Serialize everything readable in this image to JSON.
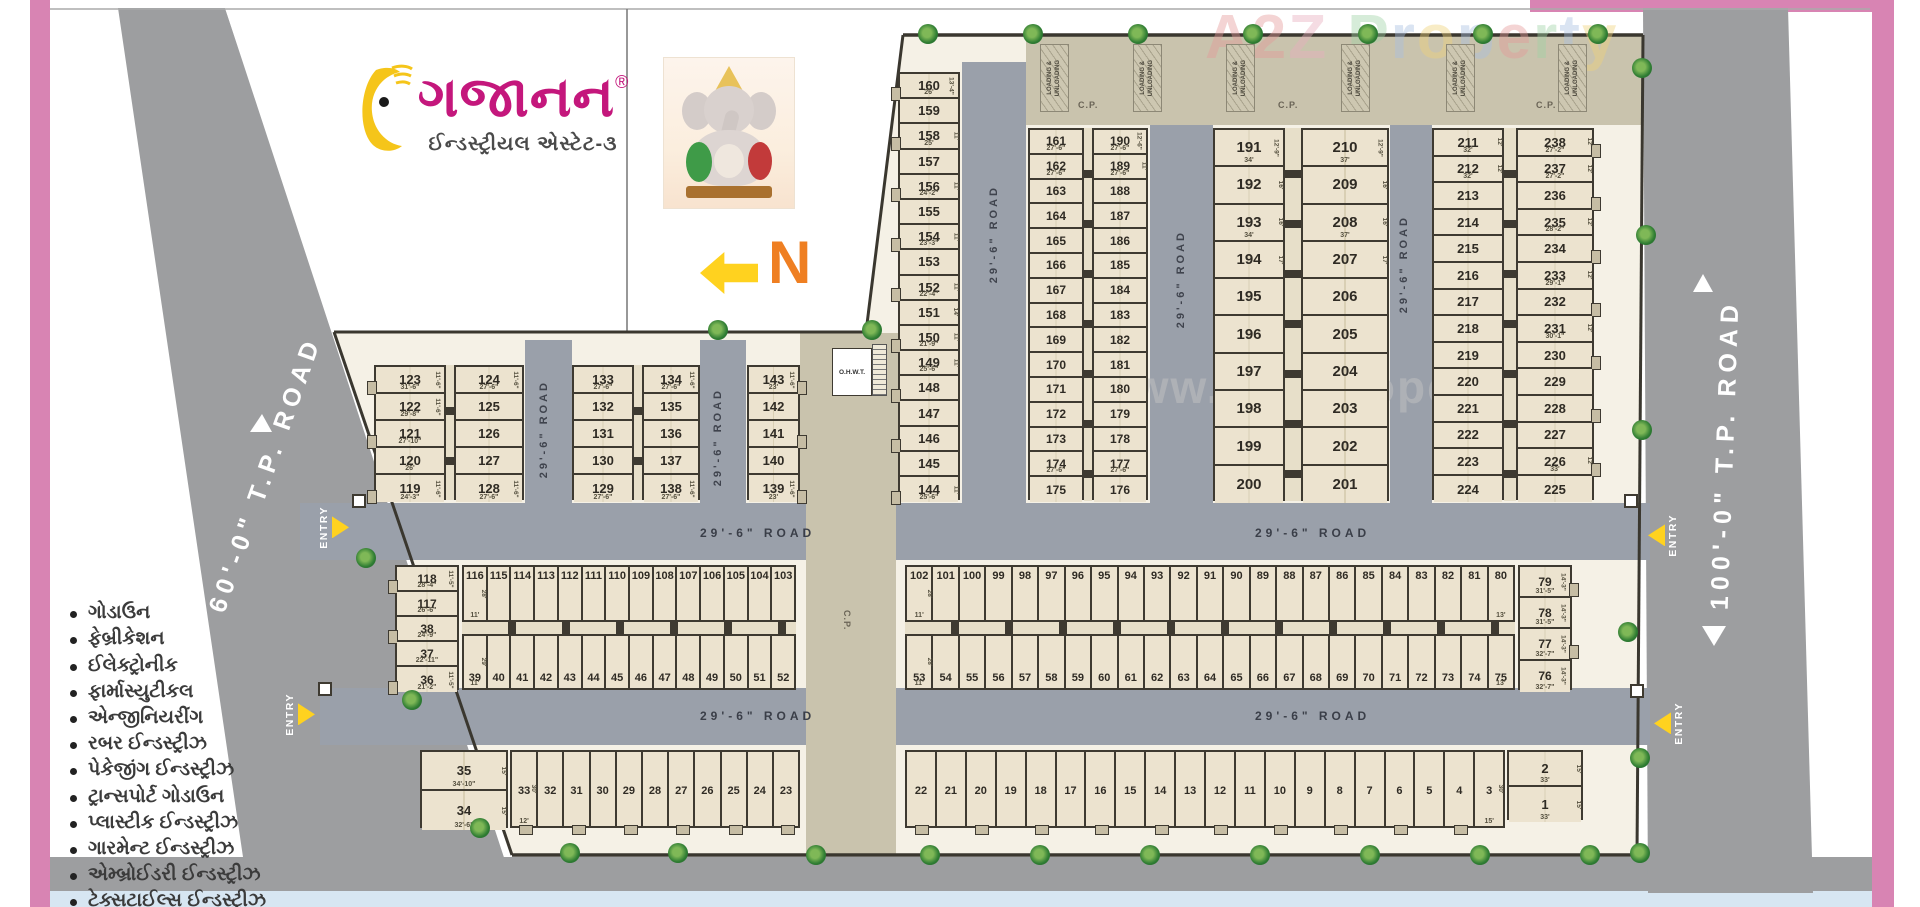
{
  "branding": {
    "name": "ગજાનન",
    "reg": "®",
    "subtitle": "ઈન્ડસ્ટ્રીયલ એસ્ટેટ-૩"
  },
  "watermarks": {
    "corner": "A2Z Property",
    "center": "www.A2ZProperty.in"
  },
  "labels": {
    "north": "N",
    "entry": "ENTRY",
    "cp": "C.P.",
    "ohwt": "O.H.W.T.",
    "loading_lines": [
      "LOADING &",
      "UNLOADING"
    ]
  },
  "roads": {
    "internal": "29'-6\" ROAD",
    "left_tp": "60'-0\" T.P. ROAD",
    "right_tp": "100'-0\" T.P. ROAD"
  },
  "industries": [
    "ગોડાઉન",
    "ફેબ્રીકેશન",
    "ઈલેક્ટ્રોનીક",
    "ફાર્માસ્યુટીકલ",
    "એન્જીનિયરીંગ",
    "રબર ઈન્ડસ્ટ્રીઝ",
    "પેકેજીંગ ઈન્ડસ્ટ્રીઝ",
    "ટ્રાન્સપોર્ટ ગોડાઉન",
    "પ્લાસ્ટીક ઈન્ડસ્ટ્રીઝ",
    "ગારમેન્ટ ઈન્ડસ્ટ્રીઝ",
    "એમ્બ્રોઈડરી ઈન્ડસ્ટ્રીઝ",
    "ટેક્સટાઈલ્સ ઈન્ડસ્ટ્રીઝ"
  ],
  "plot_blocks": {
    "colA": {
      "plots": [
        160,
        159,
        158,
        157,
        156,
        155,
        154,
        153,
        152,
        151,
        150,
        149,
        148,
        147,
        146,
        145,
        144
      ],
      "dims": {
        "160": [
          "26'",
          "13'-4\""
        ],
        "158": [
          "25'",
          "11'"
        ],
        "156": [
          "24'-2\"",
          "11'"
        ],
        "154": [
          "23'-3\"",
          "11'"
        ],
        "152": [
          "22'-4\"",
          "11'"
        ],
        "151": [
          "",
          "14'"
        ],
        "150": [
          "21'-9\"",
          "11'"
        ],
        "149": [
          "25'-6\"",
          "11'"
        ],
        "144": [
          "25'-6\"",
          "11'"
        ]
      }
    },
    "bB_L": {
      "plots": [
        161,
        162,
        163,
        164,
        165,
        166,
        167,
        168,
        169,
        170,
        171,
        172,
        173,
        174,
        175
      ],
      "dims": {
        "161": [
          "27'-6\"",
          ""
        ],
        "162": [
          "27'-6\"",
          ""
        ],
        "174": [
          "27'-6\"",
          ""
        ],
        "175": [
          "",
          ""
        ]
      }
    },
    "bB_R": {
      "plots": [
        190,
        189,
        188,
        187,
        186,
        185,
        184,
        183,
        182,
        181,
        180,
        179,
        178,
        177,
        176
      ],
      "dims": {
        "190": [
          "27'-6\"",
          "12'-6\""
        ],
        "189": [
          "27'-6\"",
          "11'"
        ],
        "177": [
          "27'-6\"",
          ""
        ]
      }
    },
    "bC_L": {
      "plots": [
        191,
        192,
        193,
        194,
        195,
        196,
        197,
        198,
        199,
        200
      ],
      "dims": {
        "191": [
          "34'",
          "12'-9\""
        ],
        "192": [
          "",
          "16'"
        ],
        "193": [
          "34'",
          "16'"
        ],
        "194": [
          "",
          "17'"
        ]
      }
    },
    "bC_R": {
      "plots": [
        210,
        209,
        208,
        207,
        206,
        205,
        204,
        203,
        202,
        201
      ],
      "dims": {
        "210": [
          "37'",
          "12'-9\""
        ],
        "209": [
          "",
          "16'"
        ],
        "208": [
          "37'",
          "16'"
        ],
        "207": [
          "",
          "17'"
        ]
      }
    },
    "bD_L": {
      "plots": [
        211,
        212,
        213,
        214,
        215,
        216,
        217,
        218,
        219,
        220,
        221,
        222,
        223,
        224
      ],
      "dims": {
        "211": [
          "32'",
          "12'"
        ],
        "212": [
          "32'",
          "12'"
        ]
      }
    },
    "bD_R": {
      "plots": [
        238,
        237,
        236,
        235,
        234,
        233,
        232,
        231,
        230,
        229,
        228,
        227,
        226,
        225
      ],
      "dims": {
        "238": [
          "27'-2\"",
          "12'"
        ],
        "237": [
          "27'-2\"",
          "12'"
        ],
        "235": [
          "28'-2\"",
          "12'"
        ],
        "233": [
          "29'-1\"",
          "12'"
        ],
        "231": [
          "30'-1\"",
          "12'"
        ],
        "226": [
          "33'",
          "12'"
        ]
      }
    },
    "b119_L": {
      "plots": [
        123,
        122,
        121,
        120,
        119
      ],
      "dims": {
        "123": [
          "31'-6\"",
          "11'-6\""
        ],
        "122": [
          "29'-8\"",
          "11'-6\""
        ],
        "121": [
          "27'-10\"",
          ""
        ],
        "120": [
          "26'",
          ""
        ],
        "119": [
          "24'-3\"",
          "11'-6\""
        ]
      }
    },
    "b119_R": {
      "plots": [
        124,
        125,
        126,
        127,
        128
      ],
      "dims": {
        "124": [
          "27'-6\"",
          "11'-6\""
        ],
        "128": [
          "27'-6\"",
          "11'-6\""
        ]
      }
    },
    "b129_L": {
      "plots": [
        133,
        132,
        131,
        130,
        129
      ],
      "dims": {
        "133": [
          "27'-6\"",
          ""
        ],
        "129": [
          "27'-6\"",
          ""
        ]
      }
    },
    "b129_R": {
      "plots": [
        134,
        135,
        136,
        137,
        138
      ],
      "dims": {
        "134": [
          "27'-6\"",
          "11'-6\""
        ],
        "138": [
          "27'-6\"",
          "11'-6\""
        ]
      }
    },
    "col139": {
      "plots": [
        143,
        142,
        141,
        140,
        139
      ],
      "dims": {
        "143": [
          "23'",
          "11'-6\""
        ],
        "139": [
          "23'",
          "11'-6\""
        ]
      }
    },
    "midEdge": {
      "plots": [
        118,
        117,
        38,
        37,
        36
      ],
      "dims": {
        "118": [
          "28'-4\"",
          "11'-5\""
        ],
        "117": [
          "26'-6\"",
          ""
        ],
        "38": [
          "24'-9\"",
          ""
        ],
        "37": [
          "22'-11\"",
          ""
        ],
        "36": [
          "21'-2\"",
          "11'-5\""
        ]
      }
    },
    "midLTop": {
      "plots": [
        116,
        115,
        114,
        113,
        112,
        111,
        110,
        109,
        108,
        107,
        106,
        105,
        104,
        103
      ],
      "dims": {
        "116": [
          "11'",
          "28'"
        ]
      }
    },
    "midLBot": {
      "plots": [
        39,
        40,
        41,
        42,
        43,
        44,
        45,
        46,
        47,
        48,
        49,
        50,
        51,
        52
      ],
      "dims": {
        "39": [
          "11'",
          "29'"
        ]
      }
    },
    "midRTop": {
      "plots": [
        102,
        101,
        100,
        99,
        98,
        97,
        96,
        95,
        94,
        93,
        92,
        91,
        90,
        89,
        88,
        87,
        86,
        85,
        84,
        83,
        82,
        81,
        80
      ],
      "dims": {
        "102": [
          "11'",
          "28'"
        ],
        "80": [
          "13'",
          ""
        ]
      }
    },
    "midRBot": {
      "plots": [
        53,
        54,
        55,
        56,
        57,
        58,
        59,
        60,
        61,
        62,
        63,
        64,
        65,
        66,
        67,
        68,
        69,
        70,
        71,
        72,
        73,
        74,
        75
      ],
      "dims": {
        "53": [
          "11'",
          "28'"
        ],
        "75": [
          "13'",
          ""
        ]
      }
    },
    "midREdge": {
      "plots": [
        79,
        78,
        77,
        76
      ],
      "dims": {
        "79": [
          "31'-5\"",
          "14'-3\""
        ],
        "78": [
          "31'-5\"",
          "14'-3\""
        ],
        "77": [
          "32'-7\"",
          "14'-3\""
        ],
        "76": [
          "32'-7\"",
          "14'-3\""
        ]
      }
    },
    "botStackL": {
      "plots": [
        35,
        34
      ],
      "dims": {
        "35": [
          "34'-10\"",
          "15'"
        ],
        "34": [
          "32'-6\"",
          "15'"
        ]
      }
    },
    "botRowL": {
      "plots": [
        33,
        32,
        31,
        30,
        29,
        28,
        27,
        26,
        25,
        24,
        23
      ],
      "dims": {
        "33": [
          "12'",
          "30'"
        ]
      }
    },
    "botRowR": {
      "plots": [
        22,
        21,
        20,
        19,
        18,
        17,
        16,
        15,
        14,
        13,
        12,
        11,
        10,
        9,
        8,
        7,
        6,
        5,
        4,
        3
      ],
      "dims": {
        "3": [
          "15'",
          "30'"
        ]
      }
    },
    "botStackR": {
      "plots": [
        2,
        1
      ],
      "dims": {
        "2": [
          "33'",
          "15'"
        ],
        "1": [
          "33'",
          "15'"
        ]
      }
    }
  }
}
